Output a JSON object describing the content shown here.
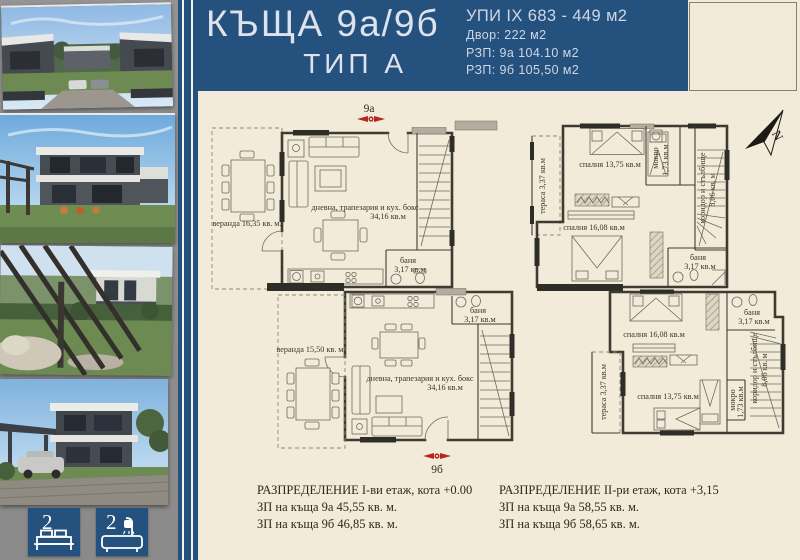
{
  "header": {
    "title_line1": "КЪЩА 9а/9б",
    "title_line2": "ТИП А",
    "info_lines": [
      "УПИ IX 683 - 449 м2",
      "Двор: 222 м2",
      "РЗП: 9а 104.10 м2",
      "РЗП: 9б 105,50 м2"
    ]
  },
  "sidebar": {
    "photos": [
      "street-view-render",
      "house-front-render",
      "garden-pergola-render",
      "house-corner-render"
    ],
    "stats": [
      {
        "icon": "bed-icon",
        "value": "2"
      },
      {
        "icon": "bath-icon",
        "value": "2"
      }
    ]
  },
  "plans": {
    "first_floor": {
      "marker_top": "9а",
      "marker_bottom": "9б",
      "veranda_a": "веранда 16,35 кв. м.",
      "veranda_b": "веранда 15,50 кв. м.",
      "living_name": "дневна, трапезария и кух. бокс",
      "living_area": "34,16 кв.м",
      "bath_name": "баня",
      "bath_area": "3,17 кв.м"
    },
    "second_floor": {
      "north_letter": "N",
      "terrace": "тераса 3,37 кв.м",
      "bedroom_13": "спалня 13,75 кв.м",
      "bedroom_16": "спалня 16,08 кв.м",
      "wet_name": "мокро",
      "wet_area": "1,73 кв.м",
      "corridor_name": "коридор и стълбище",
      "corridor_area": "8,06 кв. м",
      "bath_name": "баня",
      "bath_area": "3,17 кв.м"
    }
  },
  "captions": {
    "first_floor": {
      "title": "РАЗПРЕДЕЛЕНИЕ I-ви етаж, кота +0.00",
      "line2": "ЗП на къща 9а 45,55 кв. м.",
      "line3": "ЗП на къща 9б 46,85 кв. м."
    },
    "second_floor": {
      "title": "РАЗПРЕДЕЛЕНИЕ II-ри етаж, кота +3,15",
      "line2": "ЗП на къща 9а 58,55 кв. м.",
      "line3": "ЗП на къща 9б 58,65 кв. м."
    }
  },
  "colors": {
    "accent_blue": "#25517f",
    "background_cream": "#f2ebd9",
    "marker_red": "#b5281e"
  }
}
